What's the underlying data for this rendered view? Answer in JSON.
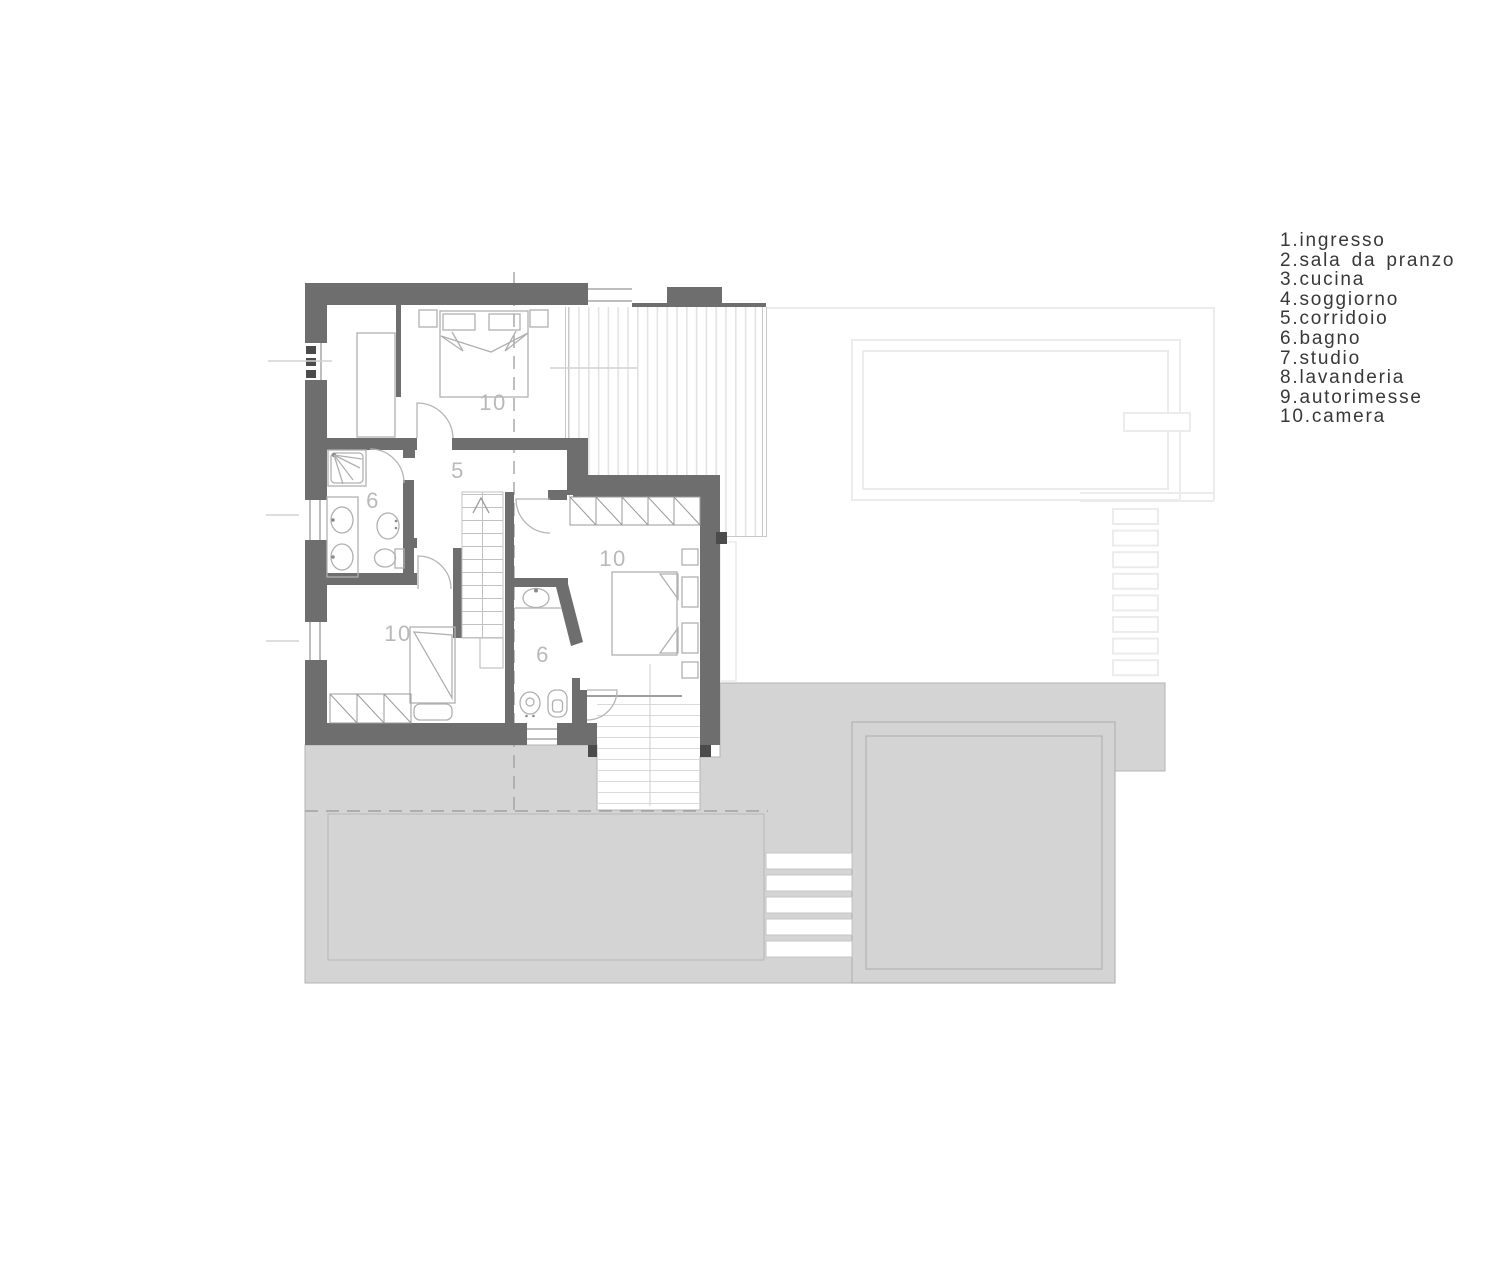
{
  "legend": {
    "items": [
      "1.ingresso",
      "2.sala da pranzo",
      "3.cucina",
      "4.soggiorno",
      "5.corridoio",
      "6.bagno",
      "7.studio",
      "8.lavanderia",
      "9.autorimesse",
      "10.camera"
    ]
  },
  "plan": {
    "room_labels": [
      {
        "room": "camera-top",
        "text": "10"
      },
      {
        "room": "corridoio",
        "text": "5"
      },
      {
        "room": "bagno-left",
        "text": "6"
      },
      {
        "room": "camera-left",
        "text": "10"
      },
      {
        "room": "camera-right",
        "text": "10"
      },
      {
        "room": "bagno-small",
        "text": "6"
      }
    ],
    "colors": {
      "wall": "#6e6e6e",
      "wall_end": "#4b4b4b",
      "roof_gray": "#d4d4d4",
      "roof_border": "#b3b3b3",
      "hatch_line": "#e3e3e3",
      "furniture_line": "#b0b0b0",
      "label_text": "#b9b9b9",
      "legend_text": "#383838",
      "faint_line": "#ececec",
      "dash_line": "#a2a2a2"
    }
  }
}
